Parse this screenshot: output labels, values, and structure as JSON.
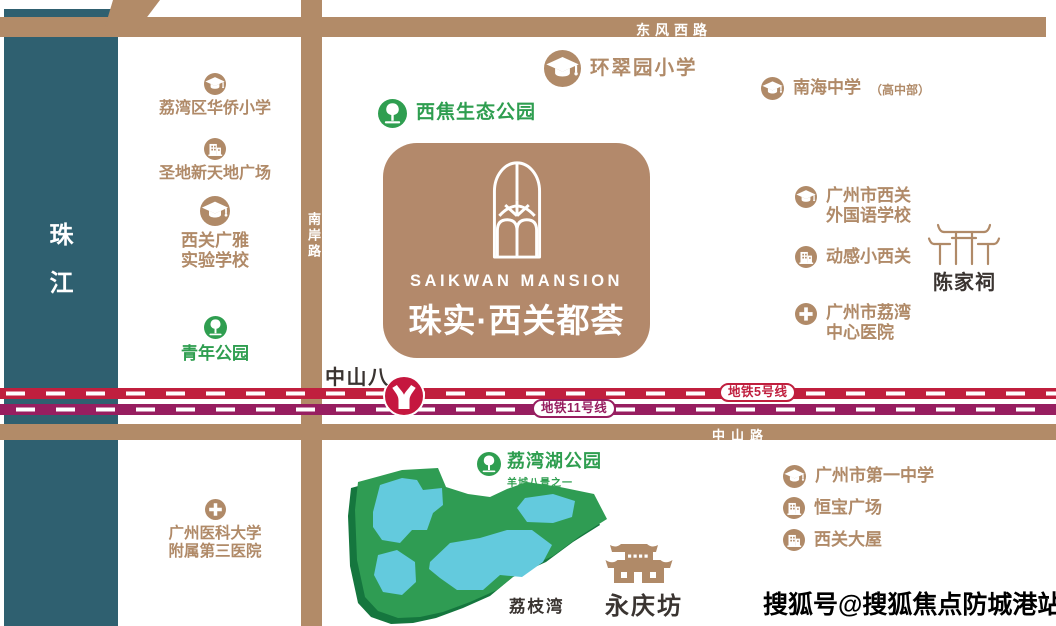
{
  "property": {
    "name_en": "SAIKWAN MANSION",
    "name_zh": "珠实·西关都荟"
  },
  "river": {
    "label": "珠江"
  },
  "roads": {
    "top": "东风西路",
    "side": "南岸路",
    "bottom": "中山路"
  },
  "metro": {
    "line5": "地铁5号线",
    "line11": "地铁11号线",
    "station": "中山八"
  },
  "parks": {
    "liwan_lake": {
      "name": "荔湾湖公园",
      "subtitle": "羊城八景之一"
    },
    "lizhiwan": {
      "name": "荔枝湾"
    }
  },
  "landmarks": {
    "chenjiaci": {
      "name": "陈家祠"
    },
    "yongqingfang": {
      "name": "永庆坊"
    }
  },
  "pois": [
    {
      "label": "荔湾区华侨小学",
      "type": "school"
    },
    {
      "label": "圣地新天地广场",
      "type": "plaza"
    },
    {
      "label": "西关广雅\n实验学校",
      "type": "school"
    },
    {
      "label": "青年公园",
      "type": "park"
    },
    {
      "label": "广州医科大学\n附属第三医院",
      "type": "hospital"
    },
    {
      "label": "西焦生态公园",
      "type": "park"
    },
    {
      "label": "环翠园小学",
      "type": "school"
    },
    {
      "label": "南海中学",
      "suffix": "（高中部）",
      "type": "school"
    },
    {
      "label": "广州市西关\n外国语学校",
      "type": "school"
    },
    {
      "label": "动感小西关",
      "type": "plaza"
    },
    {
      "label": "广州市荔湾\n中心医院",
      "type": "hospital"
    },
    {
      "label": "广州市第一中学",
      "type": "school"
    },
    {
      "label": "恒宝广场",
      "type": "plaza"
    },
    {
      "label": "西关大屋",
      "type": "plaza"
    }
  ],
  "watermark": "搜狐号@搜狐焦点防城港站",
  "colors": {
    "road": "#b28b68",
    "river": "#2f6070",
    "brand_brown": "#b3896b",
    "poi_brown": "#b08a68",
    "green_text": "#2f9e50",
    "park_fill": "#2f9c53",
    "park_shadow": "#15763e",
    "lake": "#63cadd",
    "metro_line5": "#c01f3e",
    "metro_line11": "#971e60",
    "station_red": "#c5173f",
    "dark_text": "#3a3431"
  }
}
